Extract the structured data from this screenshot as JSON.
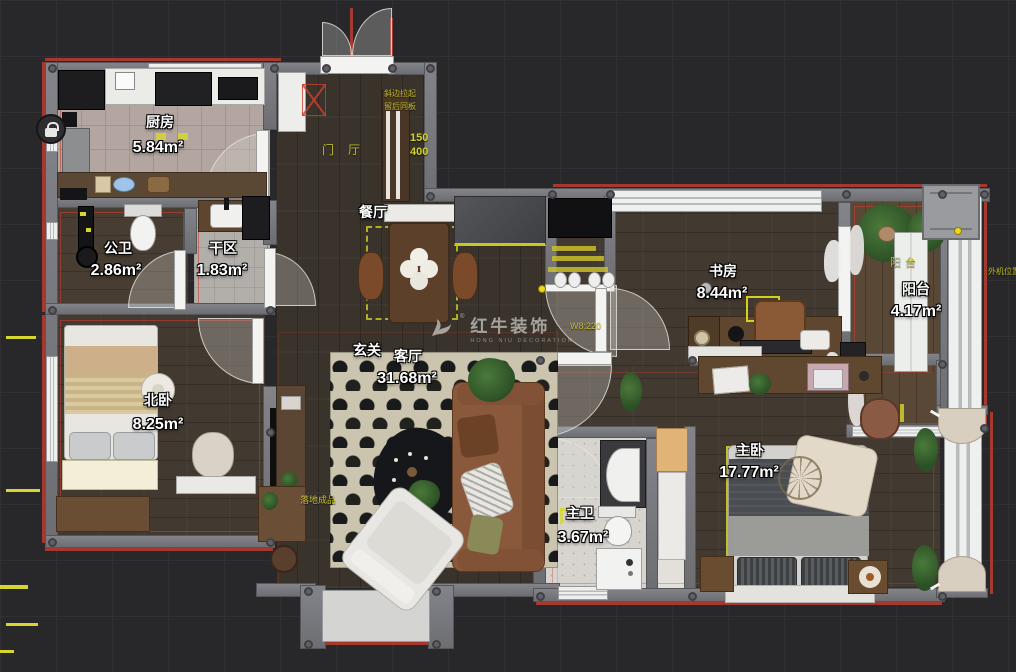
{
  "watermark": {
    "brand": "红牛装饰",
    "subtitle": "HONG NIU DECORATION",
    "registered": "®"
  },
  "rooms": {
    "kitchen": {
      "name": "厨房",
      "area": "5.84m²"
    },
    "public_bath": {
      "name": "公卫",
      "area": "2.86m²"
    },
    "dry_area": {
      "name": "干区",
      "area": "1.83m²"
    },
    "dining": {
      "name": "餐厅"
    },
    "study": {
      "name": "书房",
      "area": "8.44m²"
    },
    "balcony": {
      "name": "阳台",
      "area": "4.17m²"
    },
    "north_bedroom": {
      "name": "北卧",
      "area": "8.25m²"
    },
    "entry_hall": {
      "name": "玄关"
    },
    "living": {
      "name": "客厅",
      "area": "31.68m²"
    },
    "master_bath": {
      "name": "主卫",
      "area": "3.67m²"
    },
    "master_bedroom": {
      "name": "主卧",
      "area": "17.77m²"
    }
  },
  "floor_labels": {
    "foyer": "门厅",
    "balcony_floor": "阳台",
    "floor_item_note": "落地成品",
    "dim_150": "150",
    "dim_400": "400",
    "wall_code": "W8:220",
    "entry_note_1": "斜边拉起",
    "entry_note_2": "留后同板",
    "ac_note": "外机位置"
  },
  "colors": {
    "background": "#28282a",
    "wall": "#76777b",
    "accent_red": "#b23a30",
    "accent_yellow": "#d6d62e",
    "label_text": "#ffffff"
  }
}
